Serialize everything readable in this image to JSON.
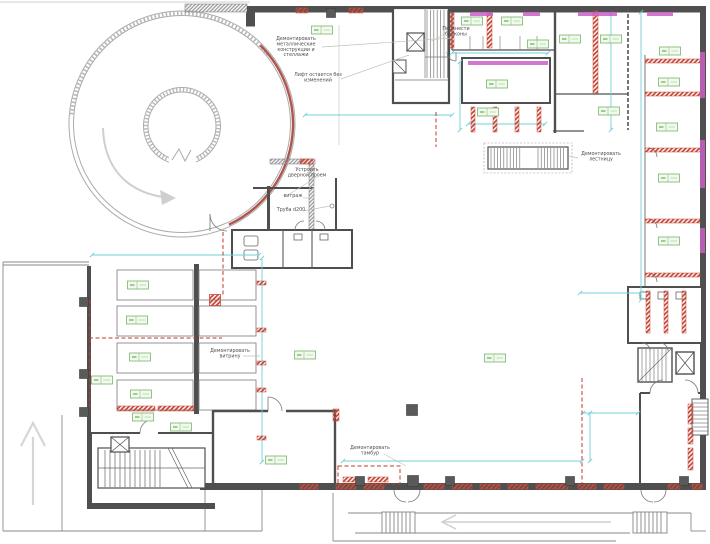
{
  "annotations": [
    {
      "id": "demolish-shelving",
      "x": 296,
      "y": 40,
      "lines": [
        "Демонтировать",
        "металлические",
        "конструкции и",
        "стеллажи"
      ]
    },
    {
      "id": "lift-unchanged",
      "x": 318,
      "y": 76,
      "lines": [
        "Лифт остается без",
        "изменений"
      ]
    },
    {
      "id": "move-balconies",
      "x": 456,
      "y": 30,
      "lines": [
        "Перенести",
        "балконы"
      ]
    },
    {
      "id": "make-door-opening",
      "x": 307,
      "y": 171,
      "lines": [
        "Устроить",
        "дверной проем"
      ]
    },
    {
      "id": "glazing",
      "x": 293,
      "y": 197,
      "lines": [
        "витраж"
      ]
    },
    {
      "id": "pipe-d200",
      "x": 291,
      "y": 211,
      "lines": [
        "Труба d200"
      ]
    },
    {
      "id": "demolish-stair",
      "x": 601,
      "y": 155,
      "lines": [
        "Демонтировать",
        "лестницу"
      ]
    },
    {
      "id": "demolish-showcase",
      "x": 230,
      "y": 352,
      "lines": [
        "Демонтировать",
        "витрину"
      ]
    },
    {
      "id": "demolish-vestibule",
      "x": 370,
      "y": 449,
      "lines": [
        "Демонтировать",
        "тамбур"
      ]
    }
  ],
  "leaders": [
    [
      322,
      47,
      452,
      38
    ],
    [
      341,
      79,
      409,
      55
    ],
    [
      446,
      33,
      430,
      42
    ],
    [
      317,
      177,
      288,
      195
    ],
    [
      303,
      198,
      309,
      198
    ],
    [
      303,
      211,
      330,
      206
    ],
    [
      578,
      158,
      569,
      156
    ],
    [
      243,
      356,
      260,
      356
    ],
    [
      384,
      454,
      406,
      466
    ]
  ],
  "room_tags": [
    [
      322,
      30
    ],
    [
      472,
      21
    ],
    [
      512,
      21
    ],
    [
      538,
      44
    ],
    [
      570,
      39
    ],
    [
      611,
      39
    ],
    [
      670,
      51
    ],
    [
      669,
      82
    ],
    [
      497,
      84
    ],
    [
      609,
      111
    ],
    [
      488,
      112
    ],
    [
      667,
      127
    ],
    [
      669,
      178
    ],
    [
      669,
      241
    ],
    [
      138,
      285
    ],
    [
      137,
      320
    ],
    [
      140,
      357
    ],
    [
      141,
      394
    ],
    [
      102,
      380
    ],
    [
      305,
      355
    ],
    [
      495,
      358
    ],
    [
      276,
      460
    ],
    [
      143,
      417
    ],
    [
      181,
      427
    ]
  ],
  "red_hatch": [
    [
      296,
      8,
      12,
      5
    ],
    [
      349,
      8,
      14,
      5
    ],
    [
      450,
      13,
      4,
      35
    ],
    [
      487,
      13,
      5,
      35
    ],
    [
      593,
      11,
      5,
      82
    ],
    [
      471,
      107,
      4,
      25
    ],
    [
      493,
      107,
      4,
      25
    ],
    [
      515,
      107,
      4,
      25
    ],
    [
      537,
      107,
      4,
      25
    ],
    [
      645,
      59,
      55,
      4
    ],
    [
      645,
      92,
      55,
      4
    ],
    [
      645,
      148,
      55,
      4
    ],
    [
      645,
      219,
      55,
      4
    ],
    [
      645,
      273,
      55,
      4
    ],
    [
      646,
      291,
      4,
      42
    ],
    [
      664,
      291,
      4,
      42
    ],
    [
      682,
      291,
      4,
      42
    ],
    [
      117,
      406,
      38,
      5
    ],
    [
      158,
      406,
      36,
      5
    ],
    [
      333,
      409,
      6,
      12
    ],
    [
      257,
      281,
      9,
      4
    ],
    [
      257,
      328,
      9,
      4
    ],
    [
      257,
      361,
      9,
      4
    ],
    [
      257,
      388,
      9,
      4
    ],
    [
      257,
      436,
      9,
      4
    ],
    [
      343,
      477,
      20,
      5
    ],
    [
      368,
      477,
      20,
      5
    ],
    [
      300,
      159,
      13,
      5
    ],
    [
      300,
      484,
      18,
      5
    ],
    [
      336,
      484,
      20,
      5
    ],
    [
      364,
      484,
      20,
      5
    ],
    [
      424,
      484,
      20,
      5
    ],
    [
      452,
      484,
      20,
      5
    ],
    [
      480,
      484,
      20,
      5
    ],
    [
      508,
      484,
      20,
      5
    ],
    [
      536,
      484,
      20,
      5
    ],
    [
      556,
      484,
      12,
      5
    ],
    [
      578,
      484,
      18,
      5
    ],
    [
      604,
      484,
      20,
      5
    ],
    [
      668,
      484,
      12,
      5
    ],
    [
      692,
      484,
      10,
      5
    ],
    [
      688,
      404,
      5,
      20
    ],
    [
      688,
      428,
      5,
      16
    ],
    [
      688,
      448,
      5,
      22
    ]
  ],
  "red_dashed": [
    [
      223,
      232,
      223,
      296
    ],
    [
      89,
      338,
      222,
      338
    ],
    [
      582,
      378,
      582,
      483
    ],
    [
      436,
      112,
      436,
      147
    ],
    [
      90,
      300,
      90,
      408
    ]
  ],
  "red_dashed_rects": [
    [
      338,
      466,
      62,
      18
    ]
  ],
  "cyan_dims": [
    [
      305,
      115,
      452,
      115
    ],
    [
      460,
      62,
      460,
      130
    ],
    [
      468,
      124,
      545,
      124
    ],
    [
      452,
      53,
      548,
      53
    ],
    [
      611,
      14,
      611,
      130
    ],
    [
      641,
      12,
      641,
      300
    ],
    [
      580,
      293,
      641,
      293
    ],
    [
      92,
      255,
      259,
      255
    ],
    [
      262,
      258,
      262,
      462
    ],
    [
      343,
      461,
      582,
      461
    ],
    [
      583,
      413,
      638,
      413
    ],
    [
      590,
      413,
      590,
      461
    ]
  ],
  "magenta": [
    [
      470,
      12,
      23,
      4
    ],
    [
      523,
      12,
      17,
      4
    ],
    [
      578,
      12,
      39,
      4
    ],
    [
      647,
      12,
      26,
      4
    ],
    [
      468,
      61,
      80,
      4
    ],
    [
      700,
      52,
      5,
      46
    ],
    [
      700,
      140,
      5,
      48
    ],
    [
      700,
      228,
      5,
      25
    ]
  ],
  "columns": {
    "dark": [
      [
        331,
        13,
        9
      ],
      [
        360,
        481,
        9
      ],
      [
        413,
        481,
        11
      ],
      [
        450,
        481,
        9
      ],
      [
        570,
        481,
        9
      ],
      [
        684,
        481,
        9
      ],
      [
        412,
        410,
        11
      ],
      [
        84,
        302,
        9
      ],
      [
        84,
        374,
        9
      ],
      [
        84,
        412,
        9
      ]
    ],
    "red": [
      [
        215,
        300,
        11
      ]
    ]
  },
  "colors": {
    "wall": "#4f4f4f",
    "wall_light": "#8a8a8a",
    "red": "#c0392b",
    "red_hatch": "#c64a3a",
    "cyan": "#6fd0d8",
    "magenta": "#c95fc6",
    "tag_border": "#79b56a",
    "tag_fill": "#f2f9ee",
    "tag_text": "#8bc07c",
    "leader": "#b7c8b2",
    "text": "#4f4f4f",
    "arrow": "#cfcfcf",
    "circle": "#ababab"
  }
}
